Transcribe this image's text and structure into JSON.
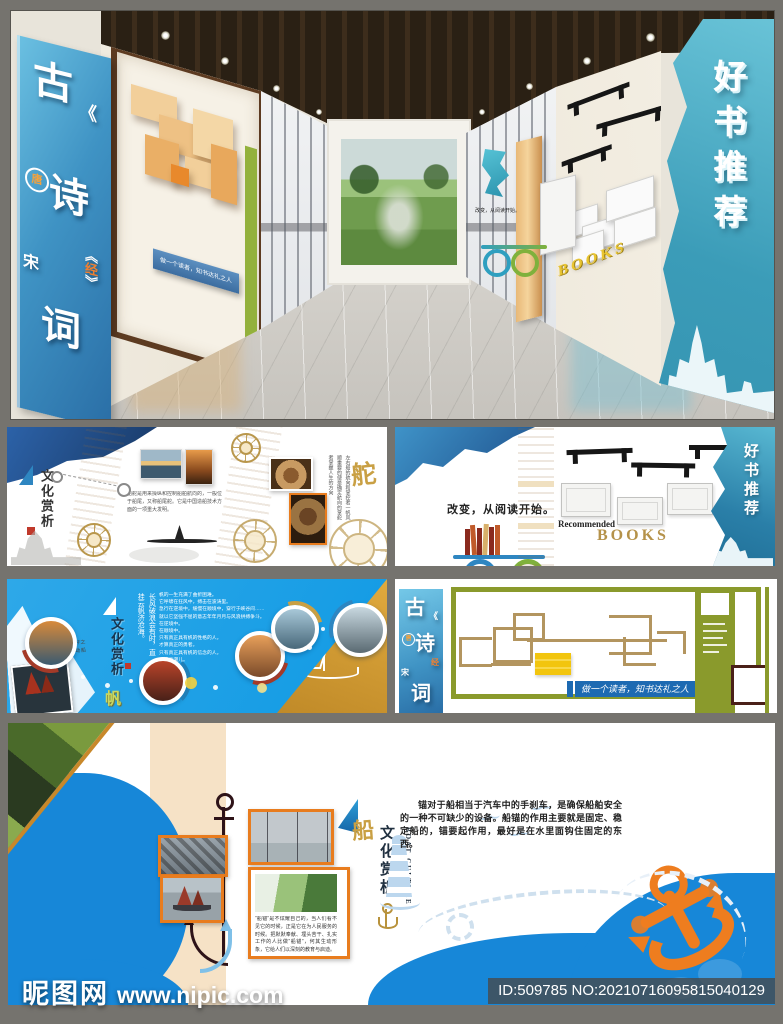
{
  "palette": {
    "page_bg": "#75736e",
    "azure": "#18a0e6",
    "navy": "#1f4f94",
    "teal_wall": "#3b9cb8",
    "olive": "#8a9a2c",
    "gold": "#c9a044",
    "orange": "#ee7d1f",
    "wood": "#eccb96",
    "banner_blue": "#1d6ab2"
  },
  "watermark": {
    "site": "昵图网",
    "url": "www.nipic.com",
    "stock_no": "ID:509785 NO:20210716095815040129"
  },
  "poetry_wall": {
    "gu": "古",
    "shi": "诗",
    "ci": "词",
    "tang": "唐",
    "song": "宋",
    "bl": "《",
    "jing": "经",
    "br": "》",
    "banner": "做一个读者，知书达礼之人"
  },
  "book_wall": {
    "title": "好书推荐",
    "books": "BOOKS",
    "recommended": "Recommended",
    "slogan": "改变，从阅读开始。"
  },
  "rudder_panel": {
    "category": "文化赏析",
    "duo": "舵",
    "body": "船舵是用来操纵和控制船舶航向的，一般位于船尾，又称船尾舵。它是中国造船技术方面的一项重大发明。",
    "side_lines": [
      "左右船的航向和掌控者",
      "一帆风顺重要的便是",
      "确定航向的掌舵者",
      "掌握人生的方向"
    ]
  },
  "sail_panel": {
    "category": "文化赏析",
    "fan": "帆",
    "quote1": "长风破浪会有时，",
    "quote2": "直挂云帆济沧海。",
    "note": "“帆”，张挂于桅杆之上，借风力推动船破浪前行。",
    "body_lines": [
      "帆的一生充满了曲折困难。",
      "它呼啸在狂风中，搏击在波涛里。",
      "急行在逆境中，缓慢在顺境中，穿行于峡谷间……",
      "就以它坚强不屈的意志年年月月与风浪拼搏争斗。",
      "在逆境中。",
      "在顺境中。",
      "只有真正具有帆的性格的人。",
      "才算真正的勇者。",
      "只有真正具有帆的信念的人。",
      "才算弄潮儿。"
    ]
  },
  "poetry_panel": {
    "banner": "做一个读者，知书达礼之人"
  },
  "anchor_panel": {
    "boat": "船",
    "category": "文化赏析",
    "sub": "之船锚",
    "en1": "BOAT",
    "en2": "CULTURE",
    "caption": "“船锚”是不炫耀自己的，当人们看不见它的时候，正是它在为人民服务的时候。把默默奉献、埋头苦干、扎实工作的人比做“船锚”，何其生动形象，它给人们以深刻的教育与启迪。",
    "body": "锚对于船相当于汽车中的手刹车，是确保船舶安全的一种不可缺少的设备。船锚的作用主要就是固定、稳定船的，锚要起作用，最好是在水里面钩住固定的东西。"
  }
}
